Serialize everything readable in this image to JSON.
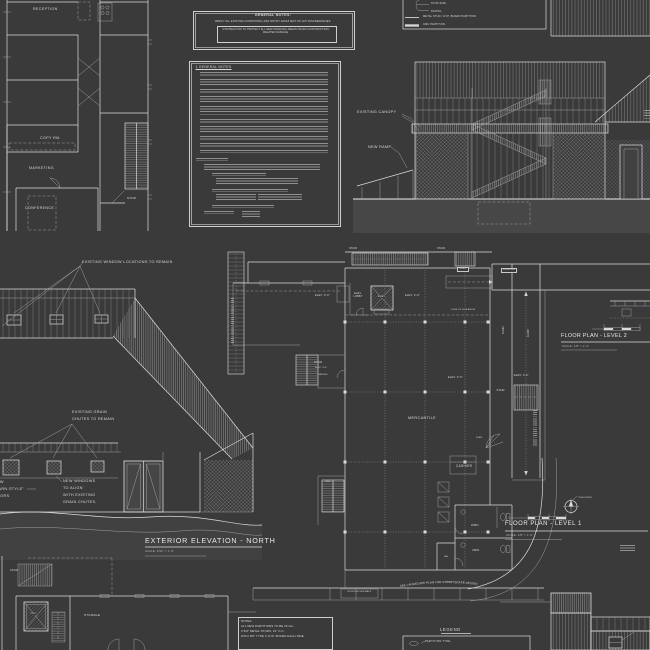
{
  "palette": {
    "background": "#3a3a3b",
    "line": "#dcdcdc",
    "dim_line": "#a9a9a9",
    "text": "#d9d9d9",
    "ground_fill": "#474748"
  },
  "general_notes_box": {
    "title": "GENERAL NOTES:",
    "note1": "VERIFY ALL EXISTING CONDITIONS, AND NOTIFY ARCHITECT OF ANY DISCREPANCIES.",
    "note2": "CONTRACTOR TO PROTECT ALL NEW WORKING AREAS FROM CONSTRUCTION-RELATED DAMAGE."
  },
  "partition_legend": {
    "stud_size": "STUD SIZE",
    "rating": "RATING",
    "metal_stud": "METAL STUD / GYP. BOARD PARTITION",
    "cmu": "CMU PARTITION"
  },
  "office_plan": {
    "reception": "RECEPTION",
    "copy_rm": "COPY RM.",
    "marketing": "MARKETING",
    "conference": "CONFERENCE",
    "stair": "STAIR"
  },
  "notes_sheet": {
    "heading": "1  GENERAL NOTES"
  },
  "section_elevation": {
    "existing_canopy": "EXISTING CANOPY",
    "new_ramp": "NEW RAMP"
  },
  "barn_elevation": {
    "windows_note": "EXISTING WINDOW LOCATIONS TO REMAIN",
    "chutes_note_l1": "EXISTING GRAIN",
    "chutes_note_l2": "CHUTES TO REMAIN",
    "doors_note_l1": "NEW",
    "doors_note_l2": "\"BARN-STYLE\"",
    "doors_note_l3": "DOORS",
    "windows_align_l1": "NEW WINDOWS",
    "windows_align_l2": "TO ALIGN",
    "windows_align_l3": "WITH EXISTING",
    "windows_align_l4": "GRAIN CHUTES.",
    "title": "EXTERIOR ELEVATION - NORTH",
    "scale": "SCALE: 3/32\" = 1'-0\""
  },
  "floor_plan": {
    "stair": "STAIR",
    "ramp": "RAMP",
    "landing": "LANDING",
    "elev_lobby_l1": "ELEV.",
    "elev_lobby_l2": "LOBBY",
    "elev": "ELEV.",
    "elev_3_6": "ELEV: 3'-6\"",
    "elev_0_0": "ELEV: 0'-0\"",
    "edge_of_slab": "EDGE OF SLAB ABOVE",
    "mercantile": "MERCANTILE",
    "cashier": "CASHIER",
    "wmn": "WMN",
    "men": "MEN",
    "jan": "JAN.",
    "existing_sidewalk": "EXISTING SIDEWALK",
    "landscape_note": "SEE LANDSCAPE PLAN FOR STREETSCAPE DESIGN",
    "true_north": "TRUE NORTH"
  },
  "plan_titles": {
    "level2": "FLOOR PLAN - LEVEL 2",
    "level2_scale": "SCALE: 1/8\" = 1'-0\"",
    "level1": "FLOOR PLAN - LEVEL 1",
    "level1_scale": "SCALE: 1/8\" = 1'-0\""
  },
  "storage_plan": {
    "stair": "STAIR",
    "storage": "STORAGE",
    "elev": "ELEV."
  },
  "partition_notes": {
    "title": "NOTES:",
    "line1": "ALL NEW PARTITIONS TO BE 25 GA.,",
    "line2": "3 5/8\" METAL STUDS, 16\" O.C.",
    "line3": "WITH 5/8\" TYPE X GYP. BOARD EACH SIDE"
  },
  "legend_bottom": {
    "title": "LEGEND",
    "partition_type": "PARTITION TYPE"
  }
}
